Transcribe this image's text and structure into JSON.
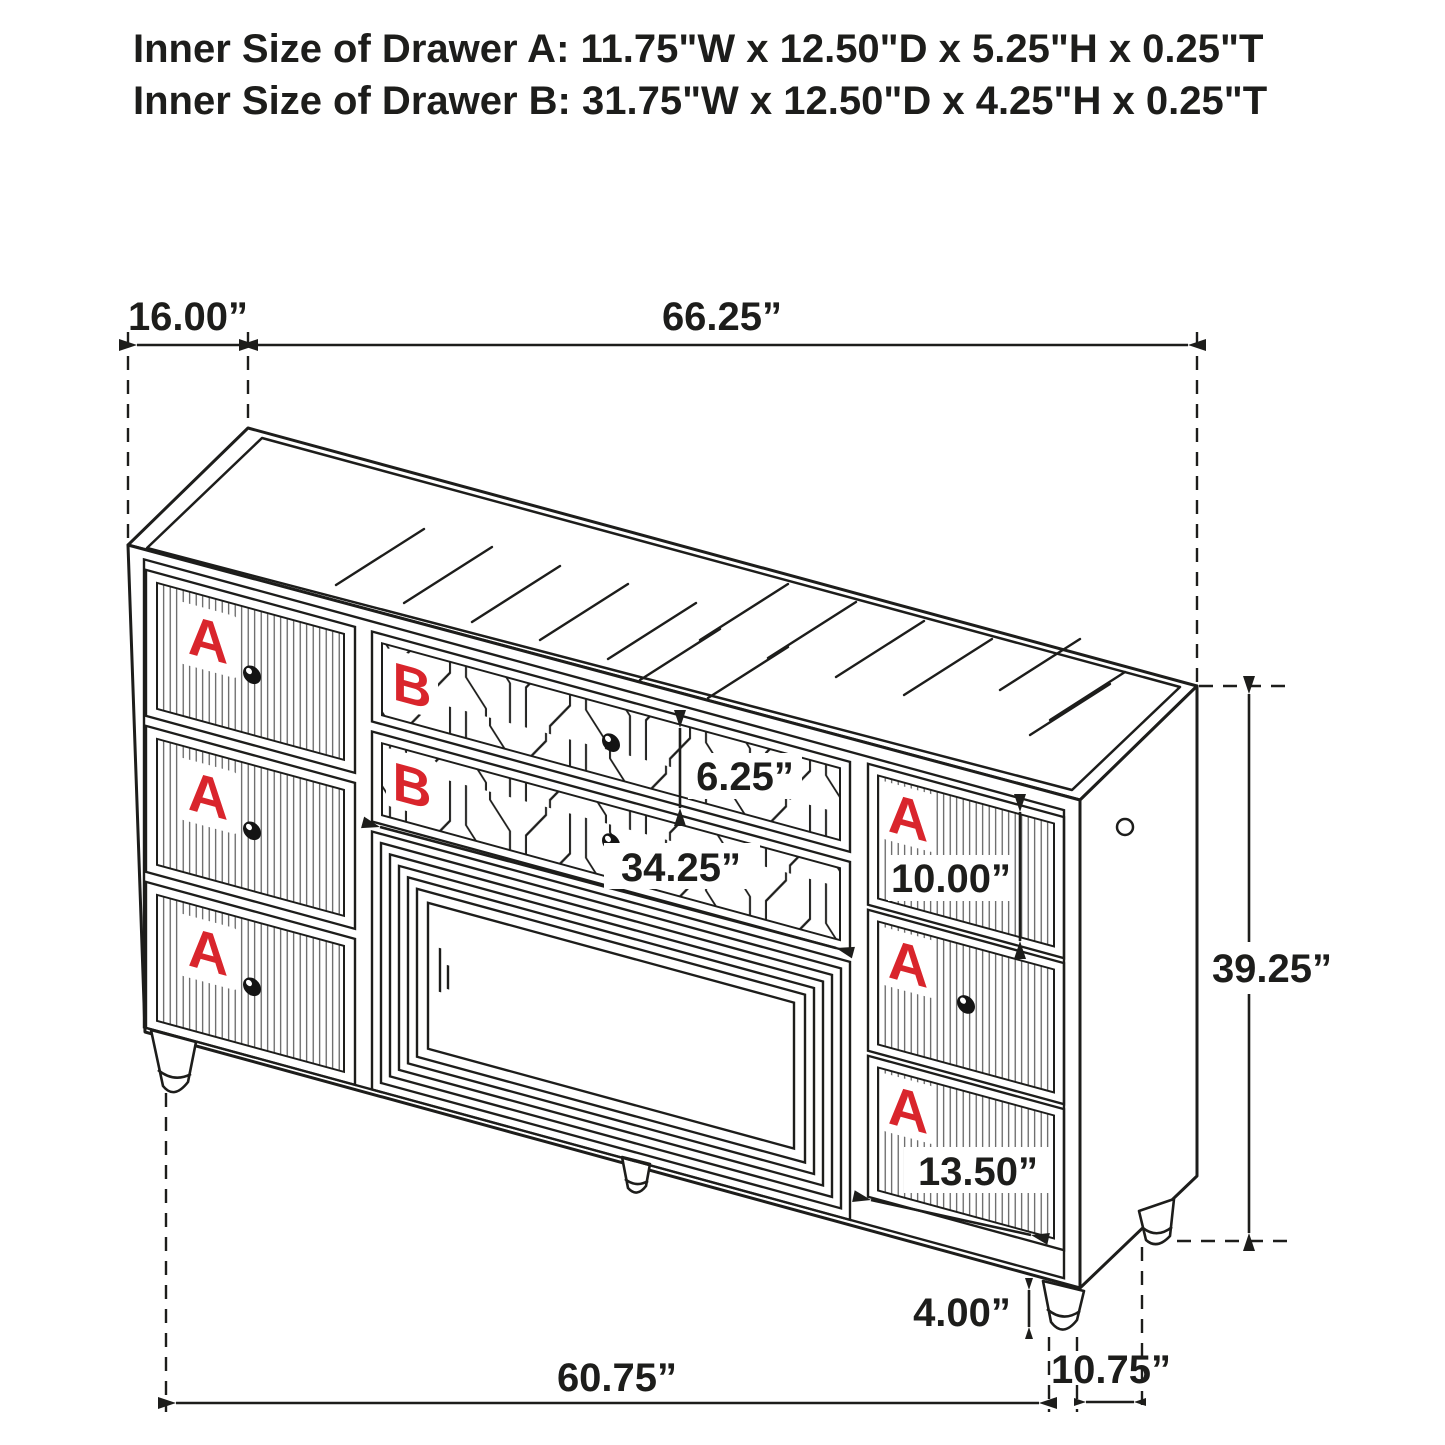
{
  "header": {
    "line1": "Inner Size of Drawer A: 11.75\"W x 12.50\"D x 5.25\"H x 0.25\"T",
    "line2": "Inner Size of Drawer B: 31.75\"W x 12.50\"D x 4.25\"H x 0.25\"T"
  },
  "dimensions": {
    "depth_top": "16.00”",
    "width_top": "66.25”",
    "drawer_b_height": "6.25”",
    "drawer_b_width": "34.25”",
    "drawer_right_height": "10.00”",
    "overall_height": "39.25”",
    "drawer_right_width": "13.50”",
    "leg_height": "4.00”",
    "base_width": "60.75”",
    "base_depth": "10.75”"
  },
  "drawers": {
    "a_label": "A",
    "b_label": "B"
  },
  "colors": {
    "line": "#1d1d1b",
    "label_red": "#d9252c",
    "background": "#ffffff"
  }
}
